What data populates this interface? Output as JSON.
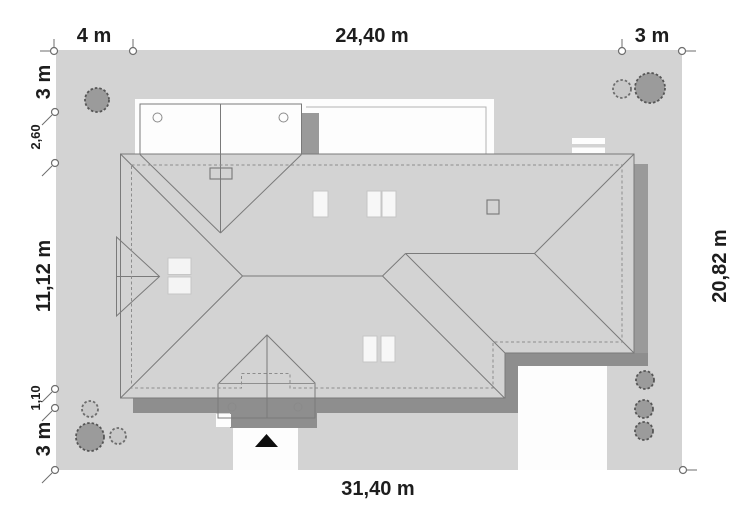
{
  "title": "House roof site plan",
  "dimensions": {
    "top": [
      "4 m",
      "24,40 m",
      "3 m"
    ],
    "left": [
      "3 m",
      "2,60",
      "11,12 m",
      "1,10",
      "3 m"
    ],
    "right": [
      "20,82 m"
    ],
    "bottom": [
      "31,40 m"
    ]
  },
  "palette": {
    "page_bg": "#ffffff",
    "plot_fill": "#d3d3d3",
    "roof_fill": "#a6a6a6",
    "garage_fill": "#a9a9a9",
    "porch_fill": "#ababab",
    "bay_fill": "#a6a6a6",
    "shadow_dark": "#8e8e8e",
    "shadow_medium": "#9a9a9a",
    "white_area": "#fdfdfd",
    "skylight_fill": "#f7f7f7",
    "chimney_fill": "#f4f4f4",
    "tree_dark": "#9b9b9b",
    "tree_light": "#c8c8c8",
    "label_color": "#1d1d1d",
    "arrow_color": "#0e0e0e"
  },
  "icons": {
    "tree": "tree-icon",
    "bush": "bush-icon",
    "entrance_arrow": "entrance-arrow-icon",
    "dimension_marker": "dimension-tick-icon"
  }
}
